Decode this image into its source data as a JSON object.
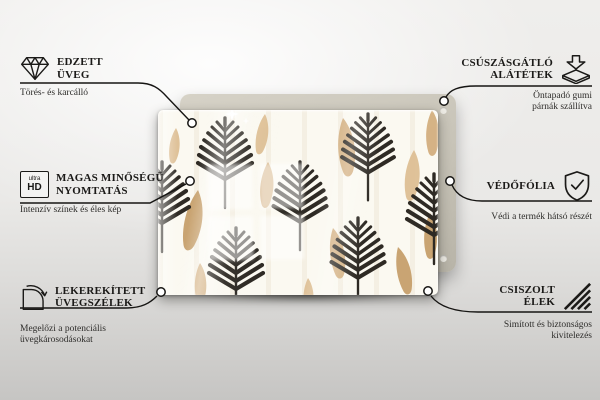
{
  "callouts": {
    "left": [
      {
        "icon": "diamond-icon",
        "title_lines": [
          "EDZETT",
          "ÜVEG"
        ],
        "subtitle_lines": [
          "Törés- és karcálló"
        ]
      },
      {
        "icon": "ultra-hd-icon",
        "title_lines": [
          "MAGAS MINŐSÉGŰ",
          "NYOMTATÁS"
        ],
        "subtitle_lines": [
          "Intenzív színek és éles kép"
        ]
      },
      {
        "icon": "rounded-corner-icon",
        "title_lines": [
          "LEKEREKÍTETT",
          "ÜVEGSZÉLEK"
        ],
        "subtitle_lines": [
          "Megelőzi a potenciális",
          "üvegkárosodásokat"
        ]
      }
    ],
    "right": [
      {
        "icon": "adhesive-pads-icon",
        "title_lines": [
          "CSÚSZÁSGÁTLÓ",
          "ALÁTÉTEK"
        ],
        "subtitle_lines": [
          "Öntapadó gumi",
          "párnák szállítva"
        ]
      },
      {
        "icon": "shield-check-icon",
        "title_lines": [
          "VÉDŐFÓLIA"
        ],
        "subtitle_lines": [
          "Védi a termék hátsó részét"
        ]
      },
      {
        "icon": "polished-edges-icon",
        "title_lines": [
          "CSISZOLT",
          "ÉLEK"
        ],
        "subtitle_lines": [
          "Simított és biztonságos",
          "kivitelezés"
        ]
      }
    ]
  },
  "icons": {
    "ultra_hd": {
      "top": "ultra",
      "bottom": "HD"
    }
  },
  "colors": {
    "line": "#161513",
    "back_panel": "#c7c3b7",
    "glass_bg": "#fbf9f1",
    "fern": "#2e2a24",
    "feather_light": "#ddbd90",
    "feather_mid": "#d2ad7c",
    "feather_dark": "#c7a06c"
  }
}
